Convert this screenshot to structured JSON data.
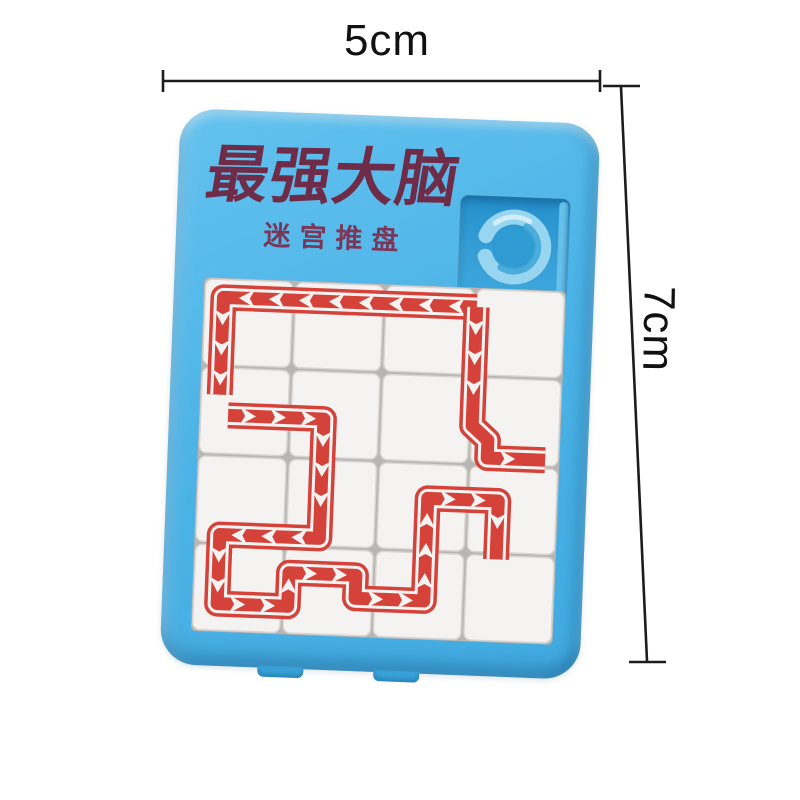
{
  "dimensions": {
    "width_label": "5cm",
    "height_label": "7cm"
  },
  "board": {
    "title": "最强大脑",
    "subtitle": "迷宫推盘",
    "colors": {
      "plate": "#4db4e7",
      "plate_edge": "#2b98d2",
      "recess": "#2a9ad2",
      "ring": "#98d5f0",
      "ring_shade": "#3fa6d6",
      "tile": "#f5f3f1",
      "tile_border": "#d8d4d1",
      "grid_gap": "#b9b5b2",
      "maze_red": "#d5423a",
      "title_text": "#6e2c49",
      "annotation": "#1c1c1c"
    }
  },
  "maze": {
    "cols": 4,
    "rows": 4,
    "paths": [
      {
        "name": "top-run",
        "points": [
          [
            3.02,
            0.22
          ],
          [
            0.22,
            0.22
          ],
          [
            0.22,
            1.32
          ]
        ]
      },
      {
        "name": "right-run",
        "points": [
          [
            3.02,
            0.22
          ],
          [
            3.02,
            1.56
          ],
          [
            3.2,
            1.72
          ],
          [
            3.2,
            1.92
          ],
          [
            3.84,
            1.92
          ]
        ]
      },
      {
        "name": "winding-run",
        "points": [
          [
            0.32,
            1.55
          ],
          [
            1.38,
            1.55
          ],
          [
            1.38,
            2.9
          ],
          [
            0.28,
            2.9
          ],
          [
            0.28,
            3.68
          ],
          [
            1.06,
            3.68
          ],
          [
            1.06,
            3.3
          ],
          [
            1.8,
            3.3
          ],
          [
            1.8,
            3.56
          ],
          [
            2.56,
            3.56
          ],
          [
            2.56,
            2.4
          ],
          [
            3.34,
            2.4
          ],
          [
            3.34,
            3.06
          ]
        ]
      }
    ]
  }
}
